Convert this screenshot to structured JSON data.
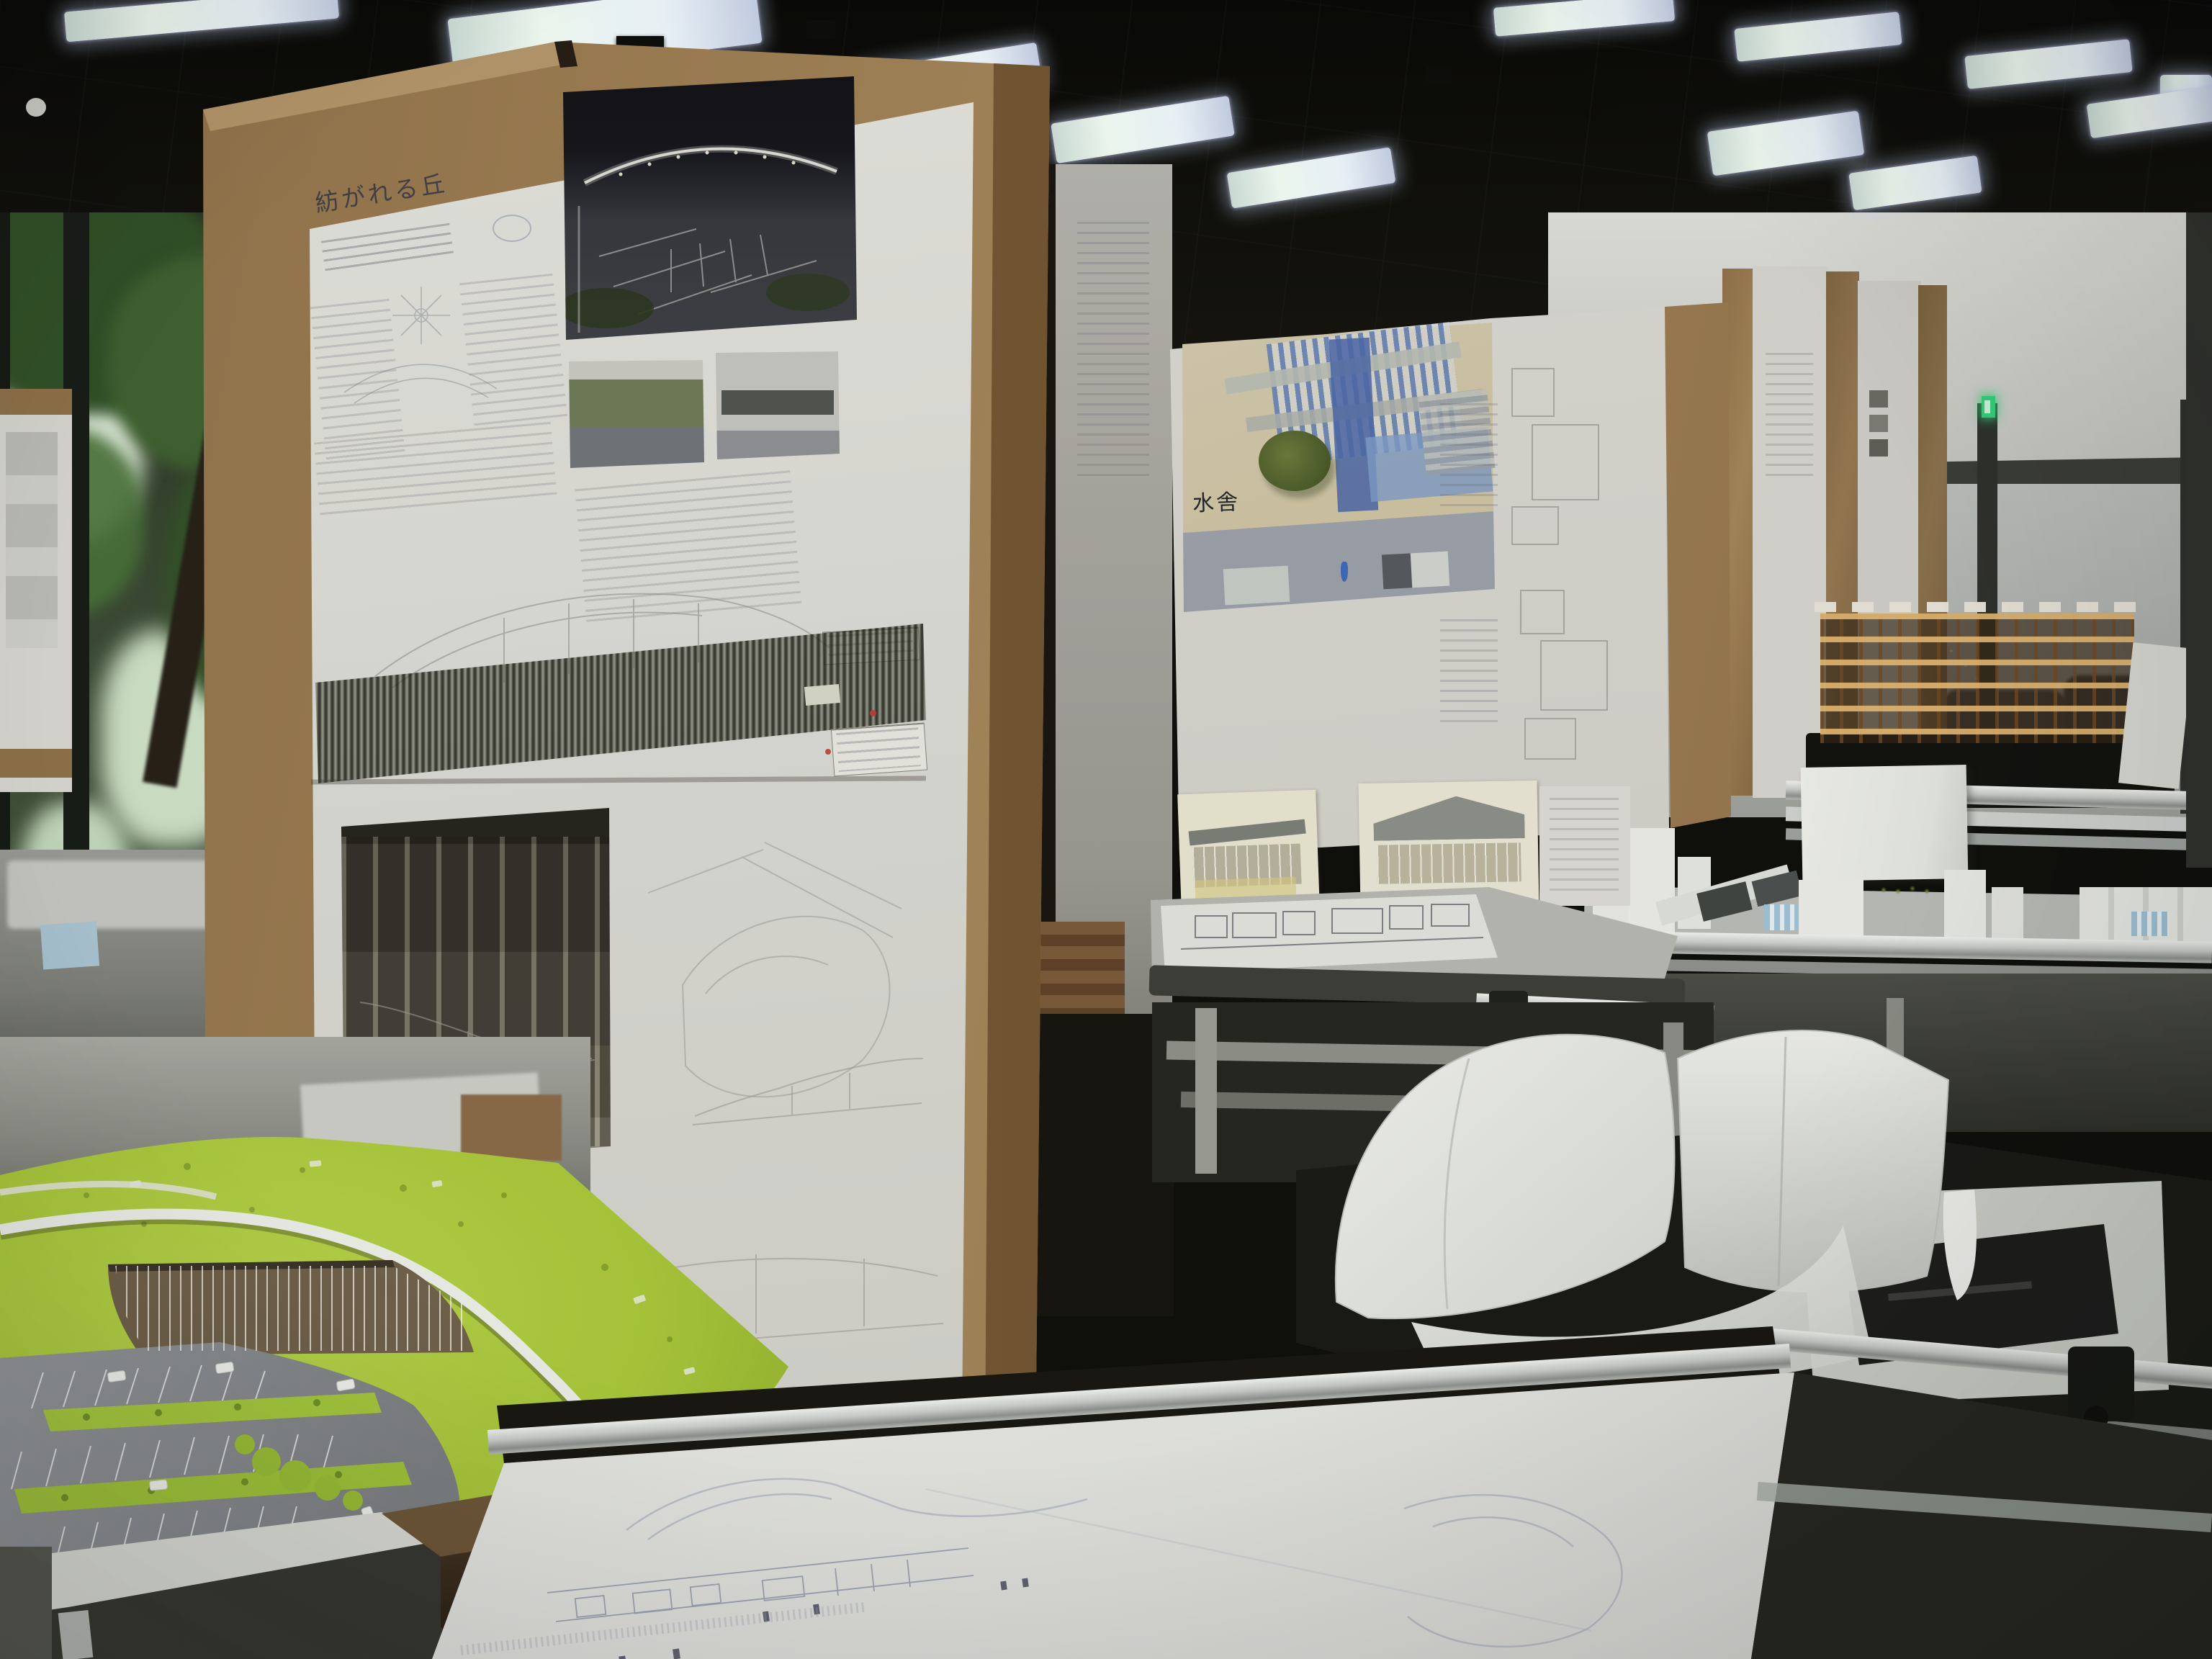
{
  "scene": {
    "type": "photograph",
    "setting": "architecture studio exhibition hall",
    "description": "Cardboard presentation boards with hand-drawn architecture posters stand on drafting tables among scale models, under a black grid ceiling with rows of fluorescent strip lights; a glass wall with trees and parked bicycles is on the left."
  },
  "boards": {
    "left": {
      "title": "紡がれる丘"
    },
    "middle": {
      "title": "水舎"
    }
  },
  "models": {
    "foreground": "green hill building model with curved white roof edge and parking lot",
    "right_white": "white foam massing model of city blocks",
    "timber": "timber post-and-beam frame model"
  },
  "palette": {
    "ceiling": "#0c0c0a",
    "cardboard": "#9a7a52",
    "paper": "#d9d8d2",
    "grass": "#a9c838",
    "parking": "#8b8e91",
    "watercolor_blue": "#5f7fb8",
    "timber_model": "#c08848",
    "foam": "#e9ebe7",
    "aluminum": "#c9ccca",
    "exit_sign": "#35d07a"
  }
}
